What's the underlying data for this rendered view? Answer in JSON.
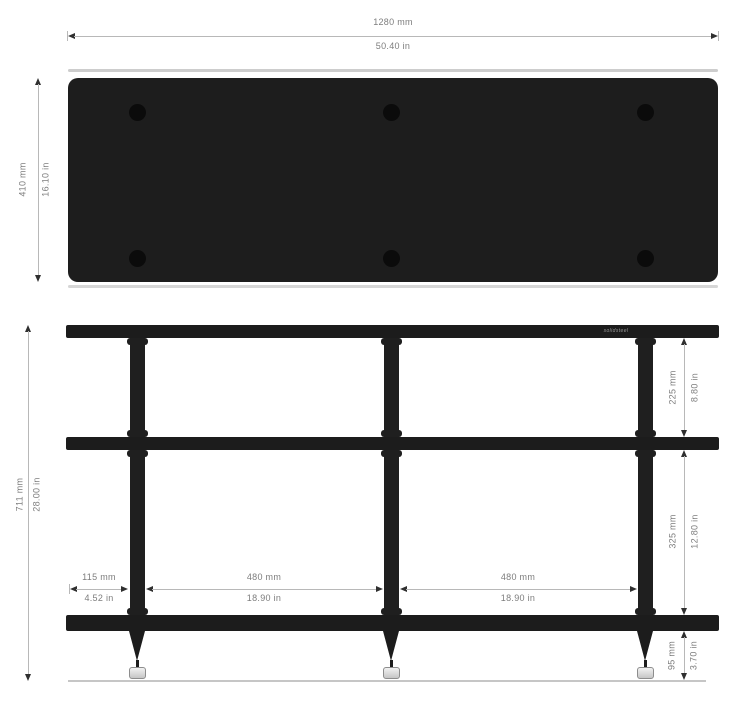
{
  "top_view": {
    "width": {
      "mm": "1280 mm",
      "inch": "50.40 in"
    },
    "depth": {
      "mm": "410 mm",
      "inch": "16.10 in"
    }
  },
  "front_view": {
    "logo": "solidsteel",
    "height": {
      "mm": "711 mm",
      "inch": "28.00 in"
    },
    "shelf_gap_upper": {
      "mm": "225 mm",
      "inch": "8.80 in"
    },
    "shelf_gap_lower": {
      "mm": "325 mm",
      "inch": "12.80 in"
    },
    "foot_height": {
      "mm": "95 mm",
      "inch": "3.70 in"
    },
    "side_offset": {
      "mm": "115 mm",
      "inch": "4.52 in"
    },
    "bay_left": {
      "mm": "480 mm",
      "inch": "18.90 in"
    },
    "bay_right": {
      "mm": "480 mm",
      "inch": "18.90 in"
    }
  },
  "colors": {
    "frame": "#1c1c1c",
    "shelf_panel": "#1d1d1d",
    "dimension_line": "#b8b8b8",
    "dimension_text": "#7d7d7d",
    "background": "#ffffff"
  }
}
